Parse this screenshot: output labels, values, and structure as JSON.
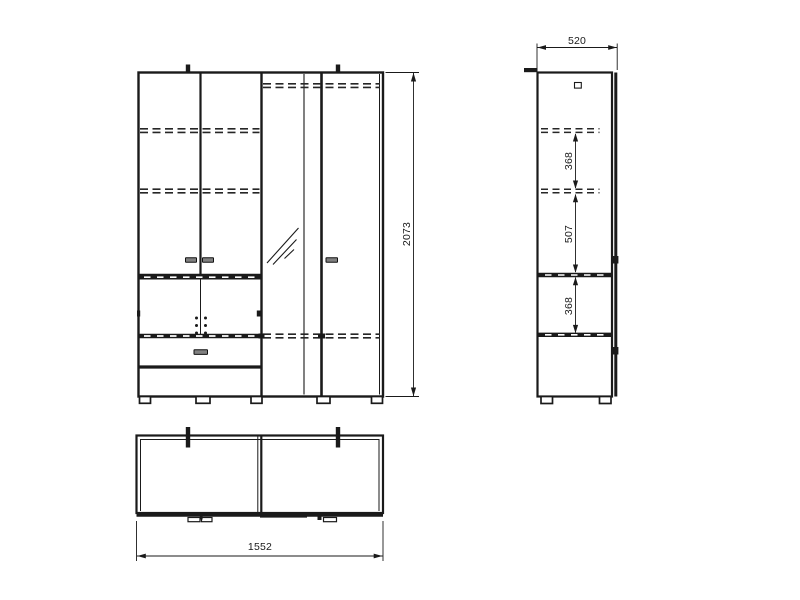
{
  "drawing": {
    "background": "#ffffff",
    "line_color": "#1a1a1a"
  },
  "dims": {
    "height": "2073",
    "depth": "520",
    "width": "1552",
    "spacing_top": "368",
    "spacing_mid": "507",
    "spacing_bottom": "368"
  }
}
